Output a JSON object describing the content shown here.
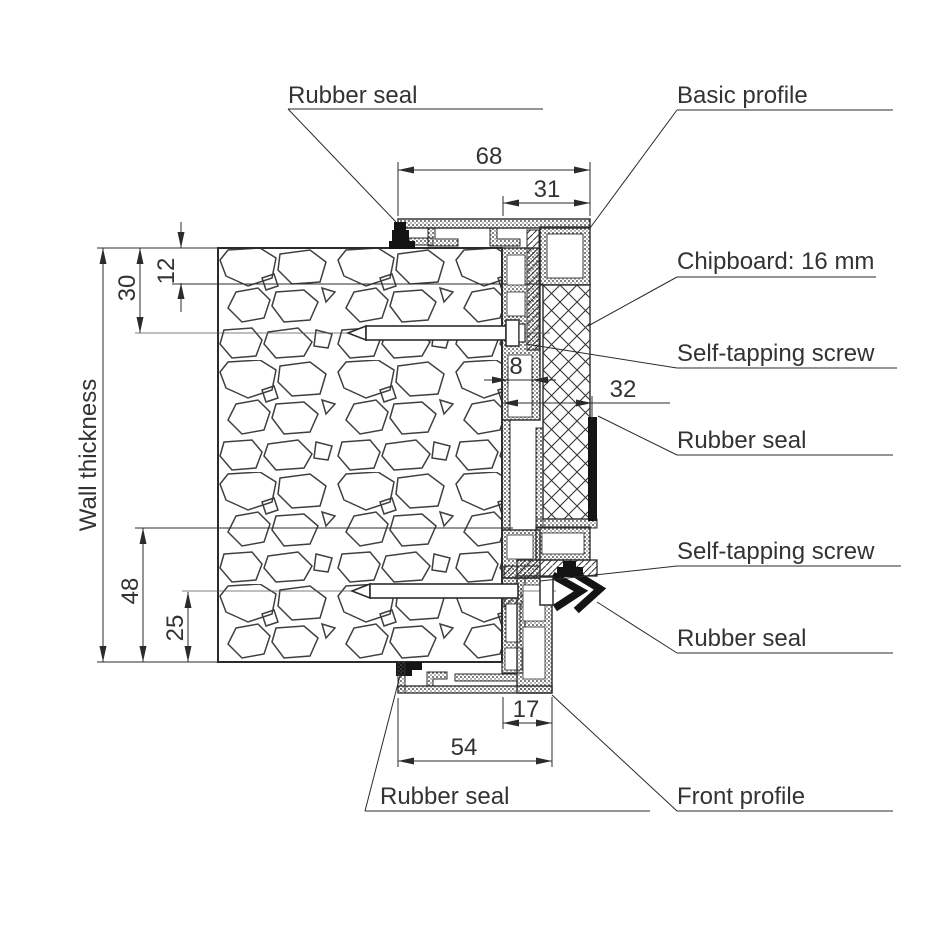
{
  "drawing": {
    "type": "door-frame cross-section technical drawing",
    "colors": {
      "line": "#2b2b2b",
      "seal": "#141414",
      "text": "#333333",
      "background": "#ffffff"
    }
  },
  "labels": {
    "rubber_seal_top": "Rubber seal",
    "basic_profile": "Basic profile",
    "chipboard": "Chipboard: 16 mm",
    "self_tapping_screw_top": "Self-tapping screw",
    "rubber_seal_side_top": "Rubber seal",
    "self_tapping_screw_bottom": "Self-tapping screw",
    "rubber_seal_side_bottom": "Rubber seal",
    "front_profile": "Front profile",
    "rubber_seal_bottom": "Rubber seal",
    "wall_thickness": "Wall thickness"
  },
  "dims": {
    "cover_width": "68",
    "profile_depth": "31",
    "seal_inset": "12",
    "screw_top_offset": "30",
    "channel_width": "8",
    "frame_overhang": "32",
    "screw_bottom_offset": "48",
    "screw_edge_offset": "25",
    "front_depth": "17",
    "front_width": "54"
  }
}
